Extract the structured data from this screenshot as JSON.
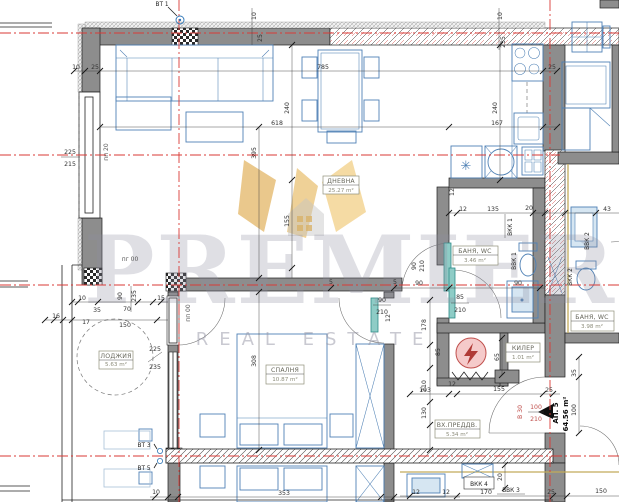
{
  "colors": {
    "axis_red": "#d93a36",
    "furniture_blue": "#4f81b5",
    "door_teal": "#2e8c88",
    "wall_gray": "#8d8d8d",
    "watermark_gold": "#e2ab42",
    "entrance_red": "#c0504d"
  },
  "watermark": {
    "brand": "PREMIER",
    "tagline": "REAL ESTATE"
  },
  "apartment": {
    "number": "АП. 5",
    "area": "64.56 m²"
  },
  "entrance": {
    "mark": "В 30",
    "width": "100",
    "height": "210"
  },
  "rooms": {
    "living": {
      "name": "ДНЕВНА",
      "area": "25.27 m²"
    },
    "bedroom": {
      "name": "СПАЛНЯ",
      "area": "10.87 m²"
    },
    "loggia": {
      "name": "ЛОДЖИЯ",
      "area": "5.63 m²"
    },
    "bath": {
      "name": "БАНЯ, WC",
      "area": "3.46 m²"
    },
    "bath_adjacent": {
      "name": "БАНЯ, WC",
      "area": "3.98 m²"
    },
    "storage": {
      "name": "КИЛЕР",
      "area": "1.01 m²"
    },
    "hall": {
      "name": "ВХ.ПРЕДДВ.",
      "area": "5.34 m²"
    }
  },
  "vents": {
    "vt1": "ВТ 1",
    "vt3": "ВТ 3",
    "vt5": "ВТ 5"
  },
  "risers": {
    "vkk1": "ВКК 1",
    "vkk2": "ВКК 2",
    "vkk4": "ВКК 4",
    "vvk1": "ВВК 1",
    "vvk2": "ВВК 2",
    "vvk3": "ВВК 3"
  },
  "levels": {
    "pp20": "пп 20",
    "pg00": "пг 00",
    "pp00": "пп 00"
  },
  "door_sizes": {
    "bath_w": "85",
    "bath_h": "210",
    "bed_w": "90",
    "bed_h": "210",
    "aux_w": "90",
    "aux_h": "210"
  },
  "window_sizes": {
    "w225": "225",
    "w215": "215",
    "l225": "225",
    "l235": "235"
  },
  "nums": {
    "n5": "5",
    "n10": "10",
    "n12": "12",
    "n15": "15",
    "n16": "16",
    "n17": "17",
    "n20": "20",
    "n25": "25",
    "n35": "35",
    "n43": "43",
    "n65": "65",
    "n70": "70",
    "n85": "85",
    "n90": "90",
    "n100": "100",
    "n103": "103",
    "n130": "130",
    "n135": "135",
    "n150": "150",
    "n155": "155",
    "n167": "167",
    "n170": "170",
    "n178": "178",
    "n210": "210",
    "n235": "235",
    "n240": "240",
    "n308": "308",
    "n353": "353",
    "n395": "395",
    "n618": "618",
    "n785": "785"
  },
  "icons": {
    "snowflake": "✳"
  }
}
